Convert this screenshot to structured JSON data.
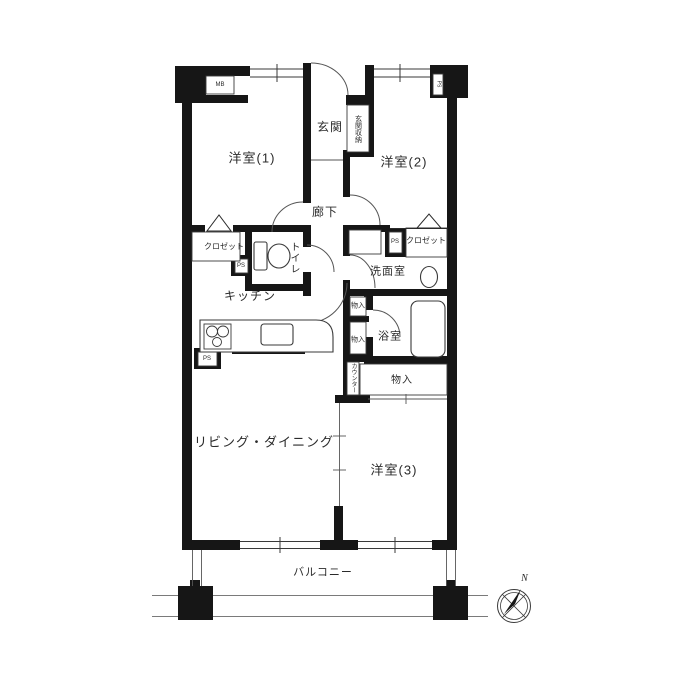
{
  "colors": {
    "wall": "#161616",
    "line": "#3a3a3a",
    "thin": "#6f6f6f",
    "background": "#ffffff"
  },
  "labels": {
    "western1": "洋室(1)",
    "western2": "洋室(2)",
    "western3": "洋室(3)",
    "entrance": "玄関",
    "entrance_storage": "玄関収納",
    "hallway": "廊下",
    "toilet": "トイレ",
    "kitchen": "キッチン",
    "living_dining": "リビング・ダイニング",
    "washroom": "洗面室",
    "bathroom": "浴室",
    "balcony": "バルコニー",
    "closet_left": "クロゼット",
    "closet_right": "クロゼット",
    "storage_small_1": "物入",
    "storage_small_2": "物入",
    "storage_large": "物入",
    "counter": "カウンター",
    "meter_box": "MB",
    "ps_pillar": "PS",
    "ps_toilet": "PS",
    "ps_washroom": "PS",
    "ps_kitchen": "PS",
    "north": "N"
  }
}
